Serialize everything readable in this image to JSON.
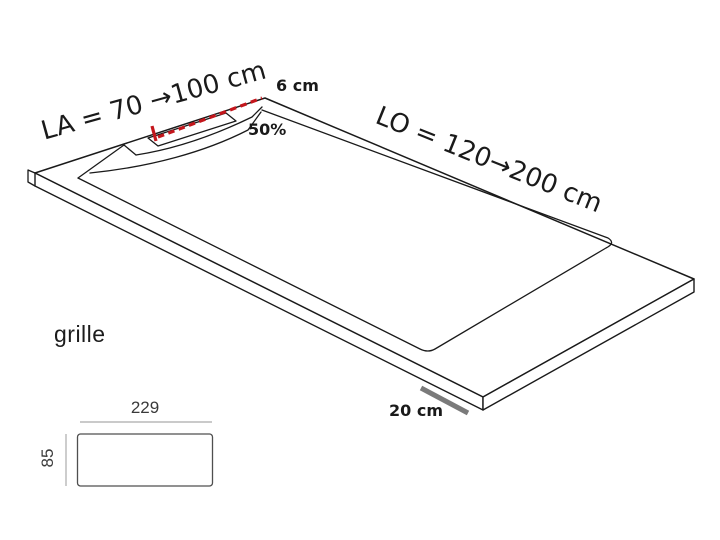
{
  "diagram": {
    "labels": {
      "width_range": "LA = 70 →100 cm",
      "length_range": "LO = 120→200 cm",
      "drain_to_edge": "6 cm",
      "slope": "50%",
      "edge_band": "20 cm"
    },
    "grille_detail": {
      "title": "grille",
      "width": "229",
      "height": "85"
    },
    "colors": {
      "ink": "#1a1a1a",
      "red_dash": "#c4161c",
      "gray_bar": "#7a7a7a",
      "dim_line": "#ababab",
      "background": "#ffffff"
    }
  }
}
